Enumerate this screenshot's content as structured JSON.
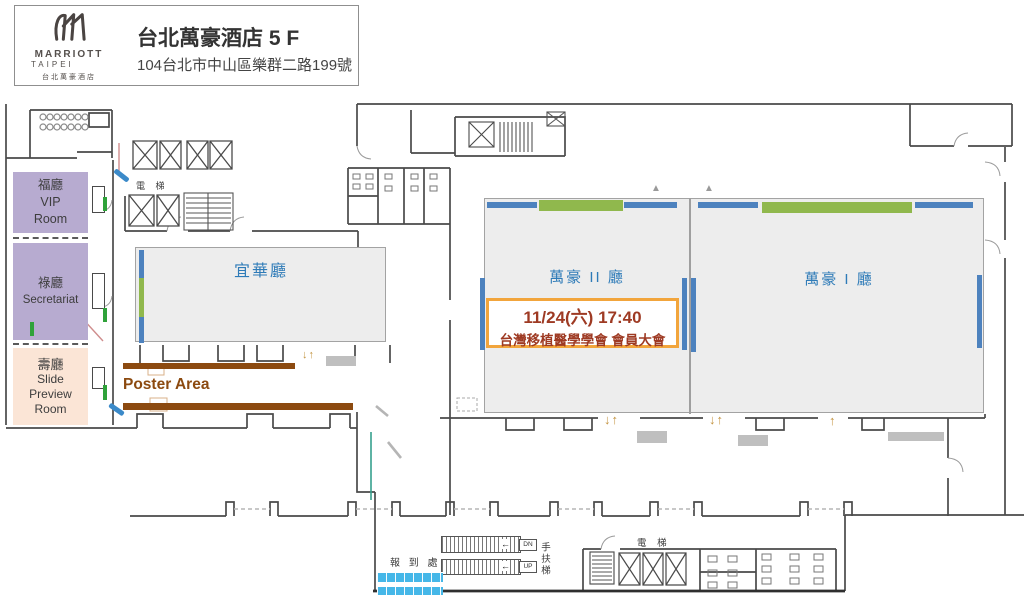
{
  "header": {
    "brand": "MARRIOTT",
    "brand_sub": "TAIPEI",
    "brand_cn": "台北萬豪酒店",
    "title": "台北萬豪酒店 5 F",
    "address": "104台北市中山區樂群二路199號"
  },
  "rooms": {
    "vip": {
      "lines": [
        "福廳",
        "VIP",
        "Room"
      ]
    },
    "secretariat": {
      "lines": [
        "祿廳",
        "Secretariat"
      ]
    },
    "slide_preview": {
      "lines": [
        "壽廳",
        "Slide",
        "Preview",
        "Room"
      ]
    },
    "yihua": {
      "name": "宜華廳"
    },
    "marriott_2": {
      "name": "萬豪 II 廳"
    },
    "marriott_1": {
      "name": "萬豪 I 廳"
    }
  },
  "event": {
    "line1": "11/24(六) 17:40",
    "line2": "台灣移植醫學學會 會員大會"
  },
  "labels": {
    "poster_area": "Poster Area",
    "elevator_top": "電 梯",
    "elevator_bottom": "電 梯",
    "escalator": "手扶梯",
    "registration": "報 到 處",
    "escalator_dn": "DN",
    "escalator_up": "UP",
    "arrow_down_up": "↓↑",
    "arrow_up": "↑",
    "triangle": "▲"
  },
  "colors": {
    "room_purple": "#b7abd0",
    "room_peach": "#fbe5d6",
    "hall_gray": "#ededed",
    "door_blue": "#4d82be",
    "stage_green": "#90b84d",
    "door_green": "#2fa23a",
    "poster_brown": "#8c4a10",
    "hall_label_blue": "#2e7bb8",
    "event_text_red": "#9e3a23",
    "event_border_orange": "#f2a53c",
    "registration_blue": "#45b7e8",
    "arrow_tan": "#c3933f"
  }
}
